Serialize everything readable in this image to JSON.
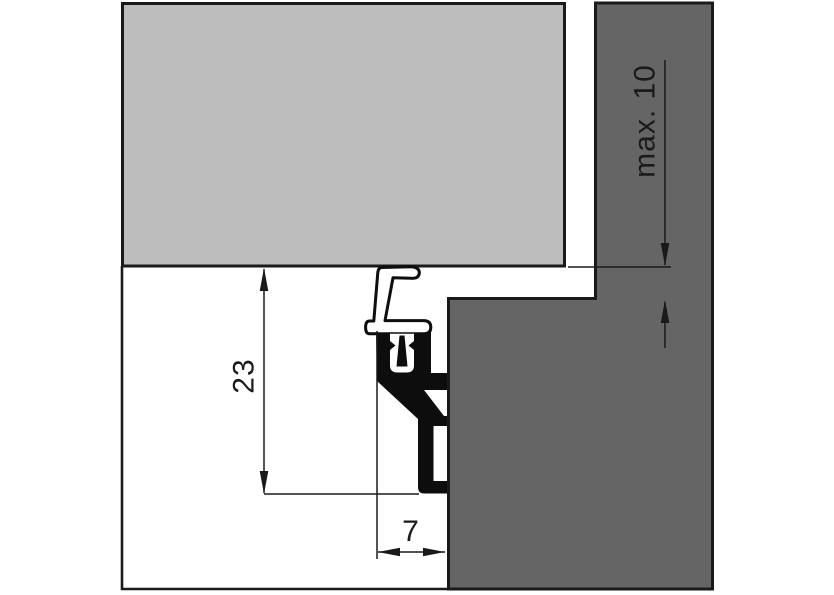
{
  "colors": {
    "panel_fill": "#bdbdbd",
    "frame_fill": "#656565",
    "profile_fill": "#0d0d0d",
    "outline": "#1a1a1a",
    "dim_color": "#1a1a1a"
  },
  "dimensions": {
    "profile_height": {
      "value": "23"
    },
    "profile_width": {
      "value": "7"
    },
    "gap": {
      "value": "max. 10"
    }
  }
}
